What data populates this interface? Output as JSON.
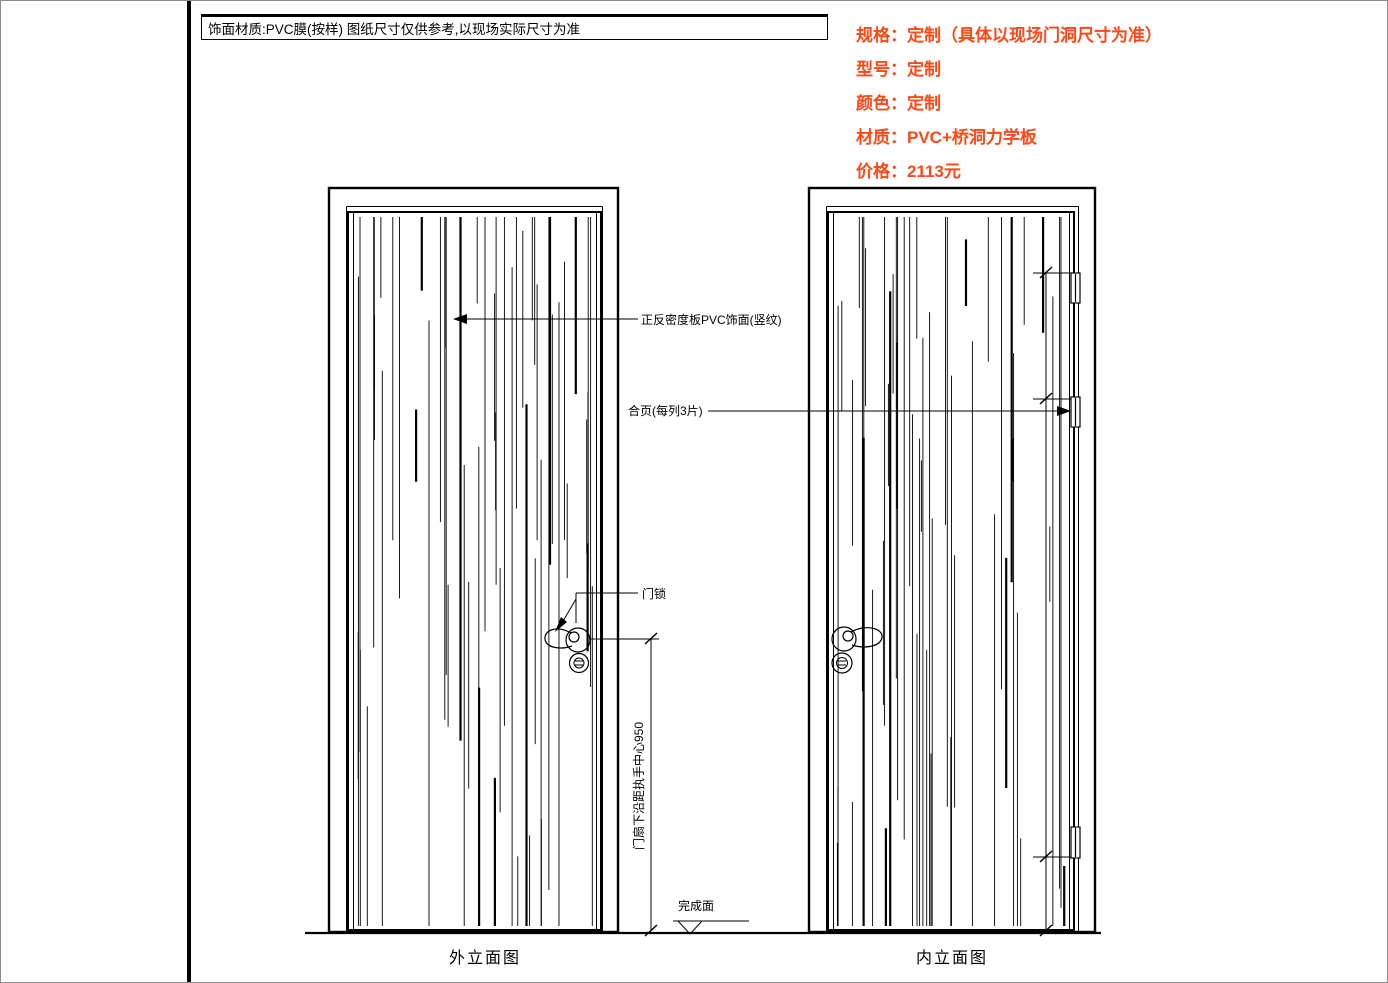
{
  "header": {
    "material_note": "饰面材质:PVC膜(按样)  图纸尺寸仅供参考,以现场实际尺寸为准"
  },
  "spec_panel": {
    "accent_color": "#fb4a17",
    "items": [
      {
        "label": "规格：",
        "value": "定制（具体以现场门洞尺寸为准）"
      },
      {
        "label": "型号：",
        "value": "定制"
      },
      {
        "label": "颜色：",
        "value": "定制"
      },
      {
        "label": "材质：",
        "value": "PVC+桥洞力学板"
      },
      {
        "label": "价格：",
        "value": "2113元"
      }
    ]
  },
  "annotations": {
    "surface_leader": "正反密度板PVC饰面(竖纹)",
    "hinge_leader": "合页(每列3片)",
    "lock_leader": "门锁",
    "handle_height_dim": "门扇下沿距执手中心950",
    "finish_level": "完成面"
  },
  "view_labels": {
    "exterior": "外立面图",
    "interior": "内立面图"
  }
}
